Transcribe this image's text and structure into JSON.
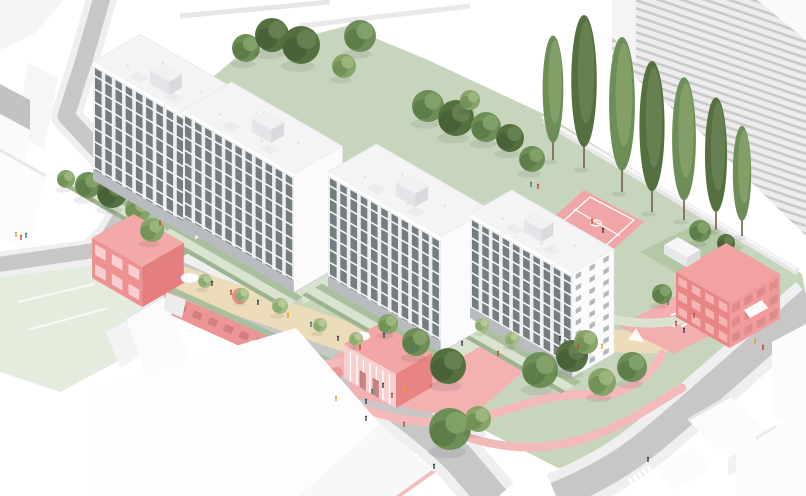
{
  "scene": {
    "type": "axonometric-site-plan-rendering",
    "subject": "housing-estate-with-four-white-slab-buildings-pink-pavilions-and-landscape",
    "palette": {
      "bg": "#ffffff",
      "road": "#c7c7c7",
      "side": "#efefef",
      "lawn": "#c8d5bd",
      "lawnPale": "#e4ecde",
      "pathGreen": "#d9e3d0",
      "hedge": "#a9bf9d",
      "hedgeDk": "#9cb490",
      "beige": "#ecdcba",
      "pinkF": "#ee9090",
      "pinkFd": "#e57e7e",
      "pinkR": "#f3a8a8",
      "pinkG": "#f3b1b1",
      "pinkP": "#f4b9b9",
      "pinkC": "#f0a6a6",
      "whiteB": "#fcfcfd",
      "shade": "#ececee",
      "facade": "#eceef0",
      "win": "#62686d",
      "roof": "#f4f4f5",
      "stripe": "#c9c9c9",
      "wall": "#e9e9e9",
      "trunk": "#6f6049"
    },
    "peopleColors": {
      "red": "#bf4a3e",
      "navy": "#37415a",
      "yellow": "#d8a62f",
      "teal": "#35806d",
      "blue": "#5b79a8"
    },
    "treeTones": {
      "dark": [
        "#55703f",
        "#46603a",
        "#6a8455"
      ],
      "mid": [
        "#6e8e58",
        "#5a7a47",
        "#86a46c"
      ],
      "light": [
        "#86a468",
        "#6f8f55",
        "#9fb981"
      ],
      "pale": [
        "#a3ba85",
        "#8aa86d",
        "#b7cc9a"
      ]
    },
    "slabs": [
      {
        "x": 93,
        "y": 62,
        "len": 118,
        "dep": 55,
        "h": 118,
        "bays": 10,
        "floors": 9
      },
      {
        "x": 183,
        "y": 110,
        "len": 128,
        "dep": 56,
        "h": 118,
        "bays": 11,
        "floors": 9
      },
      {
        "x": 328,
        "y": 172,
        "len": 130,
        "dep": 56,
        "h": 115,
        "bays": 11,
        "floors": 9
      },
      {
        "x": 470,
        "y": 214,
        "len": 118,
        "dep": 48,
        "h": 104,
        "bays": 10,
        "floors": 9,
        "endWindows": true
      }
    ],
    "pavilions": [
      {
        "name": "community-pavilion",
        "x": 92,
        "y": 278,
        "len": 58,
        "dep": 48,
        "h": 40,
        "cL": "#ee9191",
        "cR": "#e57e7e",
        "cTop": "#f3a9a9",
        "win": {
          "face": "L",
          "style": "grid",
          "cols": 3,
          "rows": 2,
          "color": "#f7cfcf"
        }
      },
      {
        "name": "entrance-pavilion",
        "x": 344,
        "y": 378,
        "len": 60,
        "dep": 42,
        "h": 34,
        "cL": "#f6cfcf",
        "cR": "#e88484",
        "cTop": "#f2a6a6",
        "win": {
          "face": "L",
          "style": "mullions",
          "color": "#ffffff",
          "door": "#b96a6a"
        }
      },
      {
        "name": "pink-apartment-building",
        "x": 676,
        "y": 317,
        "len": 62,
        "dep": 58,
        "h": 45,
        "cL": "#e88686",
        "cR": "#f19b9b",
        "cTop": "#f3a2a2",
        "win": {
          "face": "both",
          "style": "grid",
          "cols": 4,
          "rows": 3,
          "colorL": "#f4b4b4",
          "colorR": "#dd8b8b"
        }
      },
      {
        "name": "planter-box",
        "x": 664,
        "y": 254,
        "len": 26,
        "dep": 16,
        "h": 9,
        "cL": "#e8e8ea",
        "cR": "#dcdcdf",
        "cTop": "#f6f6f7"
      },
      {
        "name": "rooftop-box",
        "x": 150,
        "y": 84,
        "len": 22,
        "dep": 15,
        "h": 13,
        "cL": "#e4e5e8",
        "cR": "#d9dadd",
        "cTop": "#f1f1f3"
      },
      {
        "name": "rooftop-box",
        "x": 252,
        "y": 132,
        "len": 22,
        "dep": 15,
        "h": 13,
        "cL": "#e4e5e8",
        "cR": "#d9dadd",
        "cTop": "#f1f1f3"
      },
      {
        "name": "rooftop-box",
        "x": 396,
        "y": 196,
        "len": 22,
        "dep": 15,
        "h": 13,
        "cL": "#e4e5e8",
        "cR": "#d9dadd",
        "cTop": "#f1f1f3"
      },
      {
        "name": "rooftop-box",
        "x": 524,
        "y": 232,
        "len": 20,
        "dep": 14,
        "h": 12,
        "cL": "#e4e5e8",
        "cR": "#d9dadd",
        "cTop": "#f1f1f3"
      }
    ],
    "treesBack": [
      [
        246,
        62,
        14,
        "mid"
      ],
      [
        272,
        52,
        17,
        "dark"
      ],
      [
        301,
        64,
        19,
        "dark"
      ],
      [
        360,
        52,
        16,
        "mid"
      ],
      [
        344,
        78,
        12,
        "light"
      ],
      [
        428,
        122,
        16,
        "mid"
      ],
      [
        456,
        136,
        18,
        "dark"
      ],
      [
        486,
        142,
        15,
        "mid"
      ],
      [
        510,
        152,
        14,
        "dark"
      ],
      [
        532,
        172,
        13,
        "mid"
      ],
      [
        470,
        110,
        10,
        "light"
      ],
      [
        88,
        198,
        13,
        "mid"
      ],
      [
        112,
        208,
        15,
        "dark"
      ],
      [
        66,
        188,
        9,
        "light"
      ],
      [
        138,
        222,
        13,
        "light"
      ],
      [
        700,
        242,
        11,
        "mid"
      ],
      [
        726,
        252,
        9,
        "dark"
      ]
    ],
    "treesFront": [
      [
        152,
        242,
        12,
        "light"
      ],
      [
        205,
        288,
        7,
        "pale"
      ],
      [
        242,
        302,
        7,
        "pale"
      ],
      [
        280,
        314,
        8,
        "pale"
      ],
      [
        320,
        332,
        7,
        "pale"
      ],
      [
        356,
        346,
        7,
        "pale"
      ],
      [
        482,
        332,
        7,
        "pale"
      ],
      [
        512,
        346,
        7,
        "pale"
      ],
      [
        448,
        384,
        18,
        "dark"
      ],
      [
        416,
        356,
        14,
        "mid"
      ],
      [
        388,
        334,
        10,
        "light"
      ],
      [
        540,
        388,
        18,
        "mid"
      ],
      [
        572,
        372,
        16,
        "dark"
      ],
      [
        602,
        396,
        14,
        "light"
      ],
      [
        632,
        382,
        15,
        "mid"
      ],
      [
        586,
        354,
        12,
        "light"
      ],
      [
        450,
        450,
        21,
        "mid"
      ],
      [
        478,
        432,
        13,
        "light"
      ],
      [
        662,
        304,
        10,
        "mid"
      ]
    ],
    "poplars": [
      [
        553,
        160,
        122,
        "mid"
      ],
      [
        584,
        168,
        150,
        "dark"
      ],
      [
        622,
        192,
        152,
        "mid"
      ],
      [
        652,
        212,
        148,
        "dark"
      ],
      [
        684,
        220,
        140,
        "mid"
      ],
      [
        716,
        230,
        130,
        "dark"
      ],
      [
        742,
        236,
        108,
        "mid"
      ]
    ],
    "people": [
      [
        212,
        286,
        "navy"
      ],
      [
        231,
        295,
        "red"
      ],
      [
        258,
        305,
        "navy"
      ],
      [
        288,
        318,
        "yellow"
      ],
      [
        311,
        327,
        "teal"
      ],
      [
        338,
        341,
        "navy"
      ],
      [
        360,
        350,
        "red"
      ],
      [
        384,
        338,
        "navy"
      ],
      [
        413,
        352,
        "teal"
      ],
      [
        372,
        394,
        "teal"
      ],
      [
        383,
        388,
        "navy"
      ],
      [
        392,
        398,
        "red"
      ],
      [
        404,
        392,
        "yellow"
      ],
      [
        366,
        404,
        "navy"
      ],
      [
        404,
        427,
        "red"
      ],
      [
        366,
        421,
        "navy"
      ],
      [
        336,
        401,
        "yellow"
      ],
      [
        434,
        469,
        "navy"
      ],
      [
        648,
        462,
        "navy"
      ],
      [
        560,
        341,
        "navy"
      ],
      [
        578,
        350,
        "red"
      ],
      [
        602,
        349,
        "yellow"
      ],
      [
        592,
        224,
        "red"
      ],
      [
        603,
        233,
        "navy"
      ],
      [
        668,
        305,
        "teal"
      ],
      [
        694,
        318,
        "red"
      ],
      [
        676,
        326,
        "red"
      ],
      [
        684,
        333,
        "navy"
      ],
      [
        755,
        344,
        "yellow"
      ],
      [
        763,
        350,
        "red"
      ],
      [
        531,
        187,
        "teal"
      ],
      [
        538,
        189,
        "red"
      ],
      [
        16,
        237,
        "yellow"
      ],
      [
        21,
        240,
        "red"
      ],
      [
        26,
        238,
        "teal"
      ],
      [
        160,
        226,
        "red"
      ],
      [
        462,
        346,
        "navy"
      ],
      [
        498,
        356,
        "red"
      ]
    ],
    "pinkPaths": [
      "M338,396 C384,422 442,430 492,414 C532,402 564,390 604,396",
      "M470,438 C522,454 568,448 612,428 C646,412 664,398 682,388",
      "M252,344 C282,362 312,368 340,362",
      "M604,396 C632,390 652,374 662,354"
    ],
    "greenPaths": [
      "M556,302 C606,322 652,330 694,316"
    ],
    "gapWalks": [
      "M200,242 L252,212",
      "M300,298 L352,268",
      "M446,358 L498,328"
    ],
    "beigeBands": [
      {
        "d": "M170,278 C250,302 330,334 420,360",
        "w": 30
      },
      {
        "d": "M474,336 C540,330 600,344 662,342",
        "w": 22
      }
    ],
    "canopies": [
      [
        190,
        278,
        9,
        5
      ],
      [
        362,
        336,
        8,
        4.5
      ]
    ],
    "crosswalks": [
      {
        "x": 424,
        "y": 473,
        "rot": 46,
        "n": 7
      },
      {
        "x": 644,
        "y": 479,
        "rot": -32,
        "n": 5
      }
    ]
  }
}
